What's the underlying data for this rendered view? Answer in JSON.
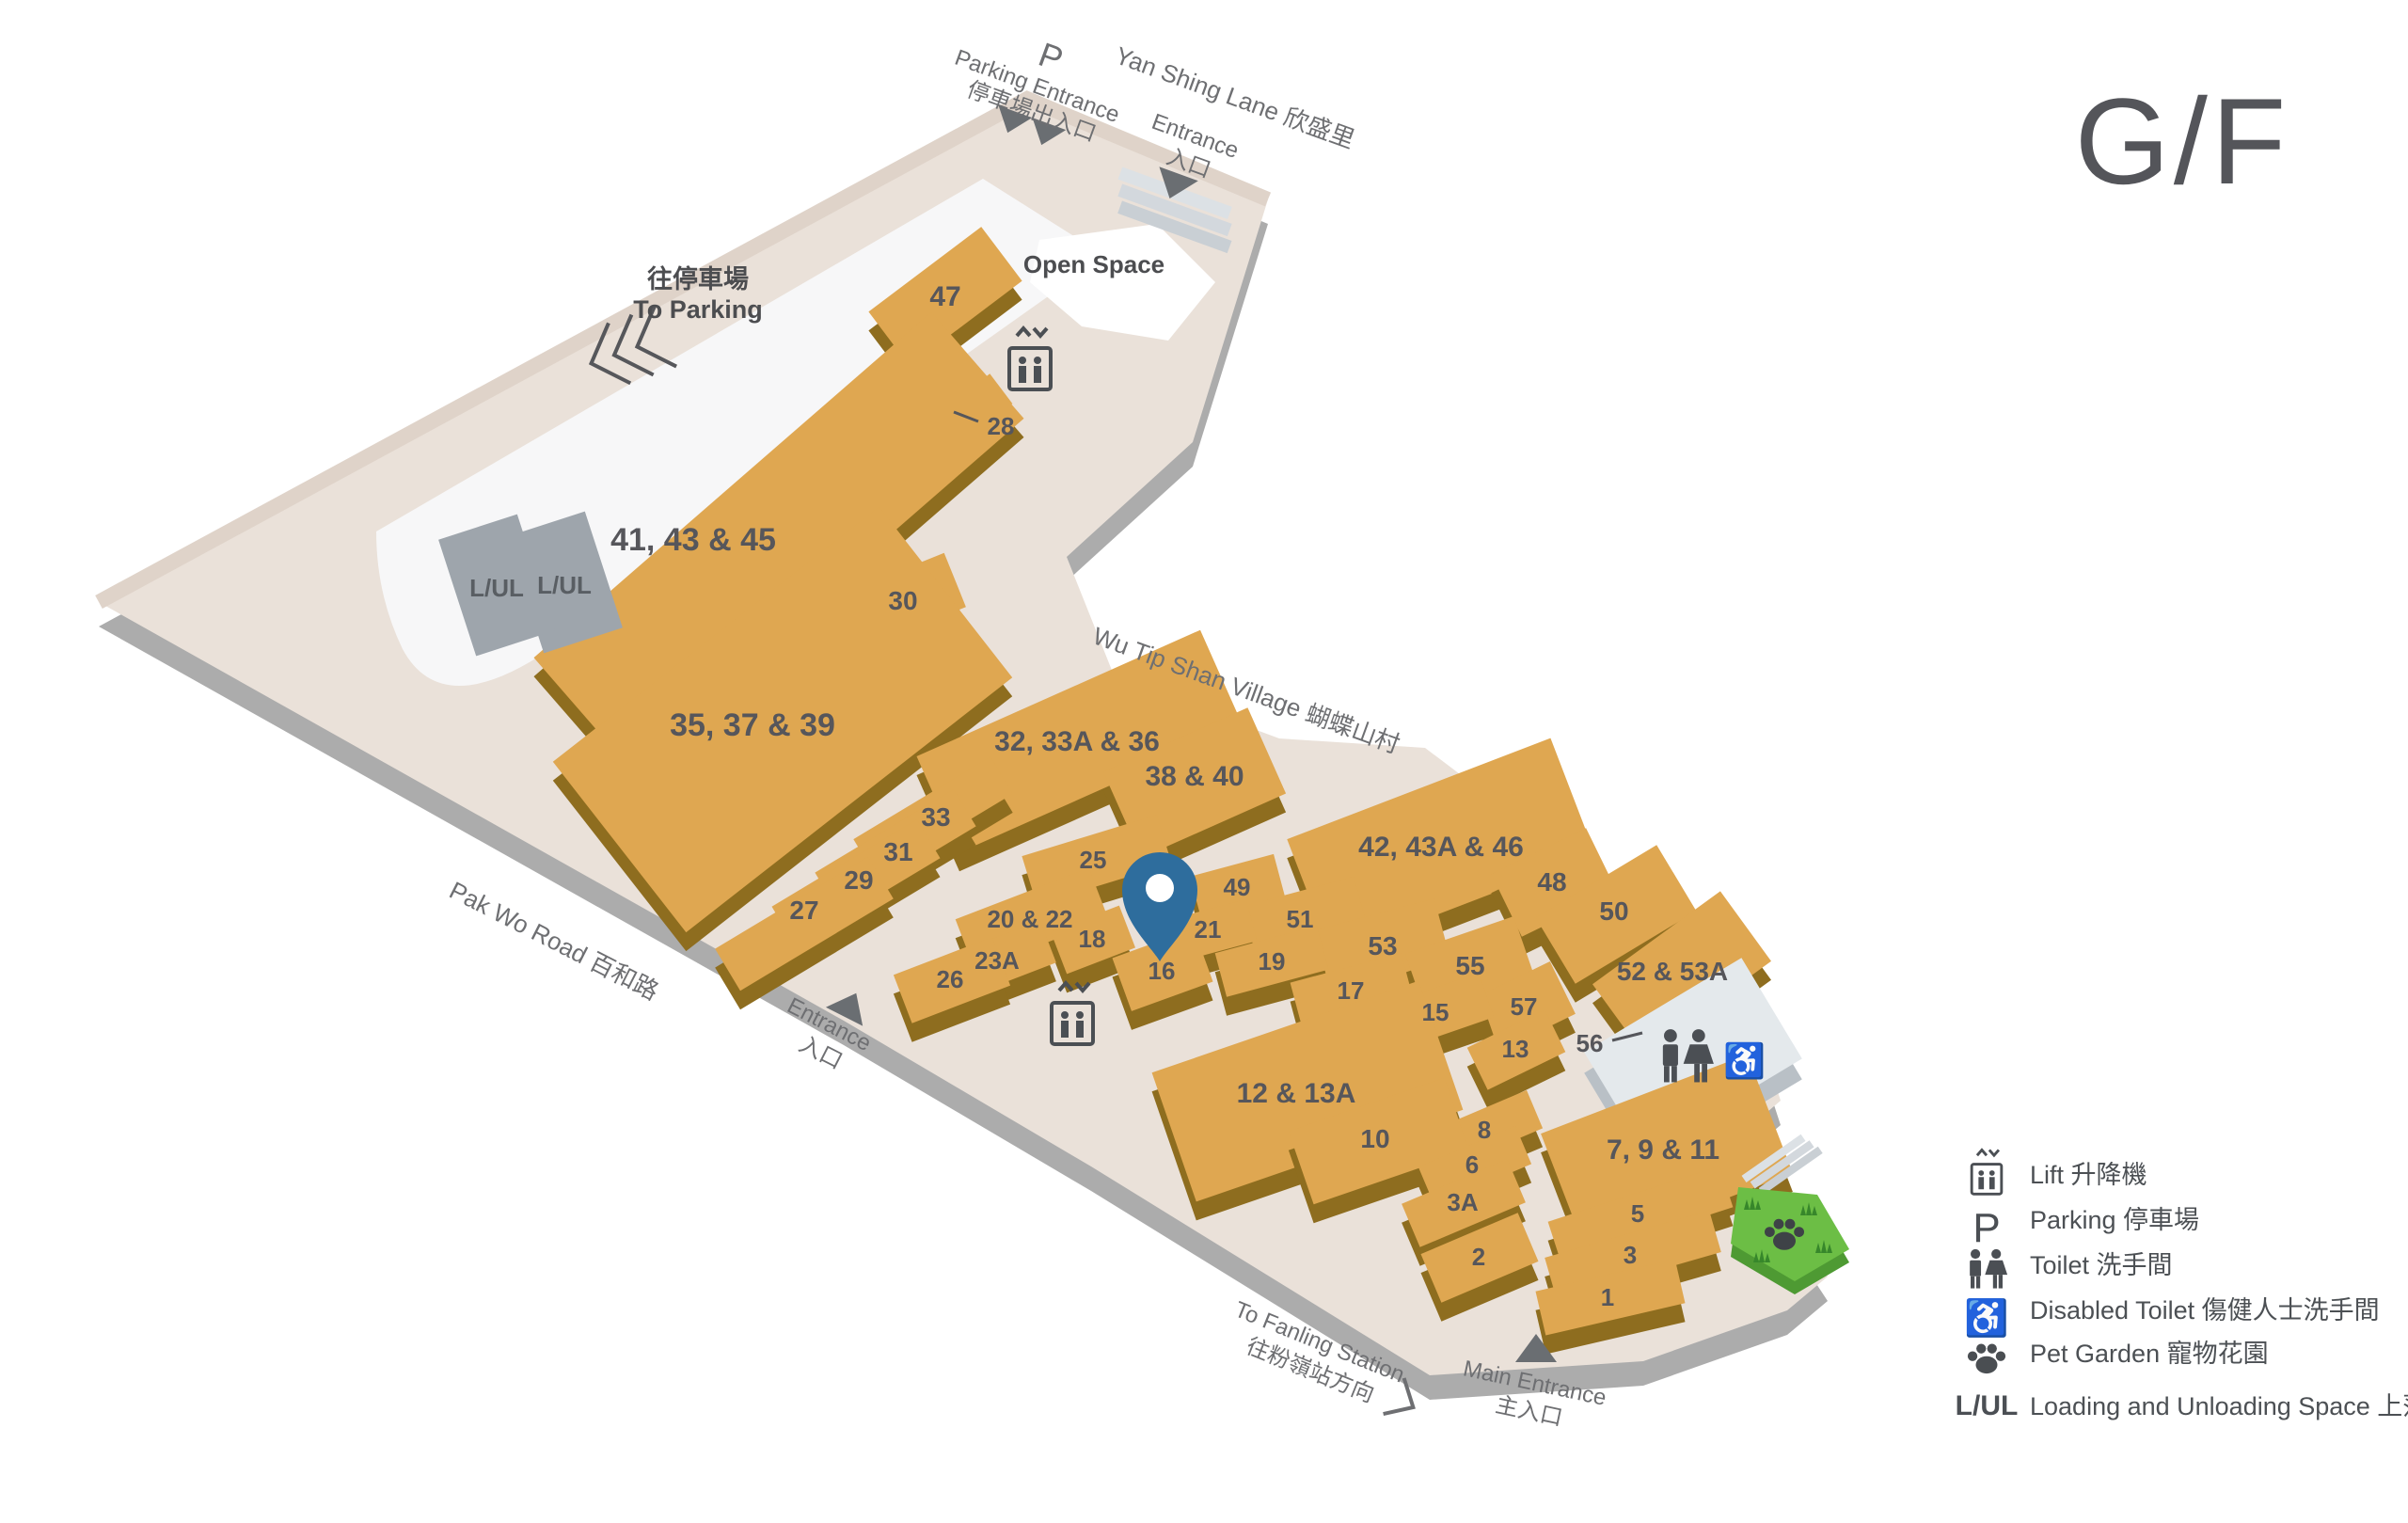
{
  "floor": "G/F",
  "roads": {
    "yan_shing_lane": "Yan Shing Lane 欣盛里",
    "wu_tip_shan_village": "Wu Tip Shan Village 蝴蝶山村",
    "pak_wo_road": "Pak Wo Road 百和路",
    "to_fanling_en": "To Fanling Station",
    "to_fanling_zh": "往粉嶺站方向"
  },
  "entrances": {
    "parking_symbol": "P",
    "parking_en": "Parking Entrance",
    "parking_zh": "停車場出入口",
    "entrance_en": "Entrance",
    "entrance_zh": "入口",
    "main_en": "Main Entrance",
    "main_zh": "主入口"
  },
  "areas": {
    "open_space": "Open Space",
    "to_parking_zh": "往停車場",
    "to_parking_en": "To Parking",
    "lul_1": "L/UL",
    "lul_2": "L/UL"
  },
  "units": {
    "u47": "47",
    "u28": "28",
    "u41_43_45": "41, 43 & 45",
    "u30": "30",
    "u35_37_39": "35, 37 & 39",
    "u33": "33",
    "u31": "31",
    "u29": "29",
    "u27": "27",
    "u32_33a_36": "32, 33A & 36",
    "u38_40": "38 & 40",
    "u42_43a_46": "42, 43A & 46",
    "u48": "48",
    "u50": "50",
    "u52_53a": "52 & 53A",
    "u25": "25",
    "u49": "49",
    "u51": "51",
    "u21": "21",
    "u19": "19",
    "u53": "53",
    "u55": "55",
    "u17": "17",
    "u15": "15",
    "u57": "57",
    "u13": "13",
    "u56": "56",
    "u20_22": "20 & 22",
    "u18": "18",
    "u23a": "23A",
    "u26": "26",
    "u16": "16",
    "u12_13a": "12 & 13A",
    "u10": "10",
    "u8": "8",
    "u6": "6",
    "u3a": "3A",
    "u2": "2",
    "u7_9_11": "7, 9 & 11",
    "u5": "5",
    "u3": "3",
    "u1": "1"
  },
  "legend": [
    {
      "icon": "lift-icon",
      "label": "Lift 升降機"
    },
    {
      "icon": "parking-icon",
      "icon_text": "P",
      "label": "Parking 停車場"
    },
    {
      "icon": "toilet-icon",
      "label": "Toilet 洗手間"
    },
    {
      "icon": "disabled-toilet-icon",
      "label": "Disabled Toilet 傷健人士洗手間"
    },
    {
      "icon": "pet-garden-icon",
      "label": "Pet Garden 寵物花園"
    },
    {
      "icon": "lul-icon",
      "icon_text": "L/UL",
      "label": "Loading and Unloading Space 上落貨停車位"
    }
  ],
  "colors": {
    "unit_fill": "#DFA751",
    "unit_side": "#8E6D1F",
    "deck": "#EAE1D9",
    "deck_side": "#ACACAC",
    "pin": "#2E6D9D",
    "pet_garden": "#6CBE45",
    "icon_dark": "#4B4F54"
  }
}
